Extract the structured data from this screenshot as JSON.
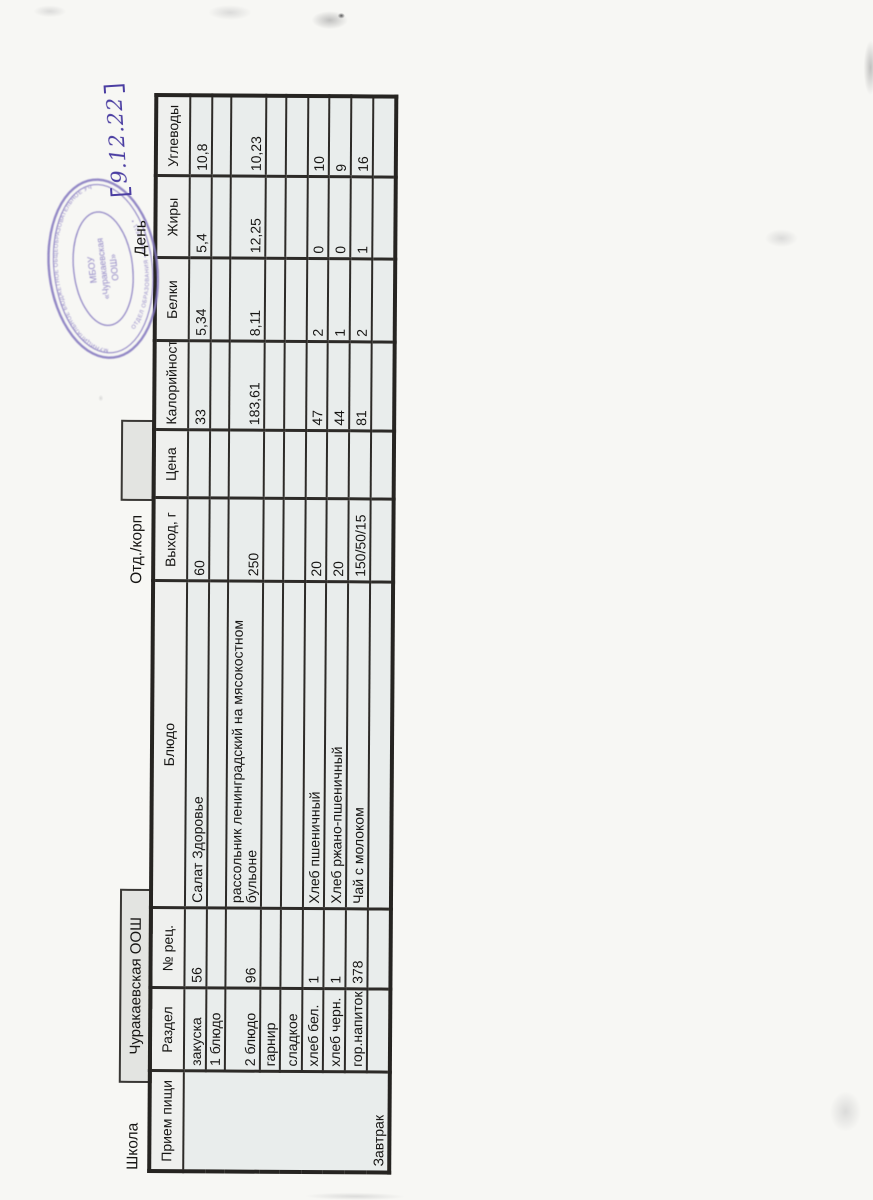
{
  "page": {
    "school_label": "Школа",
    "school_name": "Чуракаевская ООШ",
    "dept_label": "Отд./корп",
    "day_label": "День",
    "date_handwritten": "9.12.22"
  },
  "stamp": {
    "ink_color": "#8478bf",
    "center_line1": "МБОУ",
    "center_line2": "«Чуракаевская",
    "center_line3": "ООШ»",
    "ring_top": "МУНИЦИПАЛЬНОЕ БЮДЖЕТНОЕ ОБЩЕОБРАЗОВАТЕЛЬНОЕ УЧРЕЖДЕНИЕ",
    "ring_bottom": "ОТДЕЛ ОБРАЗОВАНИЯ • ИНН 1611 •"
  },
  "table": {
    "headers": [
      "Прием пищи",
      "Раздел",
      "№ рец.",
      "Блюдо",
      "Выход, г",
      "Цена",
      "Калорийность",
      "Белки",
      "Жиры",
      "Углеводы"
    ],
    "meal": "Завтрак",
    "rows": [
      {
        "razdel": "закуска",
        "num": "56",
        "dish": "Салат Здоровье",
        "out": "60",
        "price": "",
        "kcal": "33",
        "protein": "5,34",
        "fat": "5,4",
        "carbs": "10,8"
      },
      {
        "razdel": "1 блюдо",
        "num": "",
        "dish": "",
        "out": "",
        "price": "",
        "kcal": "",
        "protein": "",
        "fat": "",
        "carbs": ""
      },
      {
        "razdel": "2 блюдо",
        "num": "96",
        "dish": "рассольник ленинградский на мясокостном\nбульоне",
        "out": "250",
        "price": "",
        "kcal": "183,61",
        "protein": "8,11",
        "fat": "12,25",
        "carbs": "10,23"
      },
      {
        "razdel": "гарнир",
        "num": "",
        "dish": "",
        "out": "",
        "price": "",
        "kcal": "",
        "protein": "",
        "fat": "",
        "carbs": ""
      },
      {
        "razdel": "сладкое",
        "num": "",
        "dish": "",
        "out": "",
        "price": "",
        "kcal": "",
        "protein": "",
        "fat": "",
        "carbs": ""
      },
      {
        "razdel": "хлеб бел.",
        "num": "1",
        "dish": "Хлеб пшеничный",
        "out": "20",
        "price": "",
        "kcal": "47",
        "protein": "2",
        "fat": "0",
        "carbs": "10"
      },
      {
        "razdel": "хлеб черн.",
        "num": "1",
        "dish": "Хлеб ржано-пшеничный",
        "out": "20",
        "price": "",
        "kcal": "44",
        "protein": "1",
        "fat": "0",
        "carbs": "9"
      },
      {
        "razdel": "гор.напиток",
        "num": "378",
        "dish": "Чай  с молоком",
        "out": "150/50/15",
        "price": "",
        "kcal": "81",
        "protein": "2",
        "fat": "1",
        "carbs": "16"
      },
      {
        "razdel": "",
        "num": "",
        "dish": "",
        "out": "",
        "price": "",
        "kcal": "",
        "protein": "",
        "fat": "",
        "carbs": ""
      }
    ]
  }
}
